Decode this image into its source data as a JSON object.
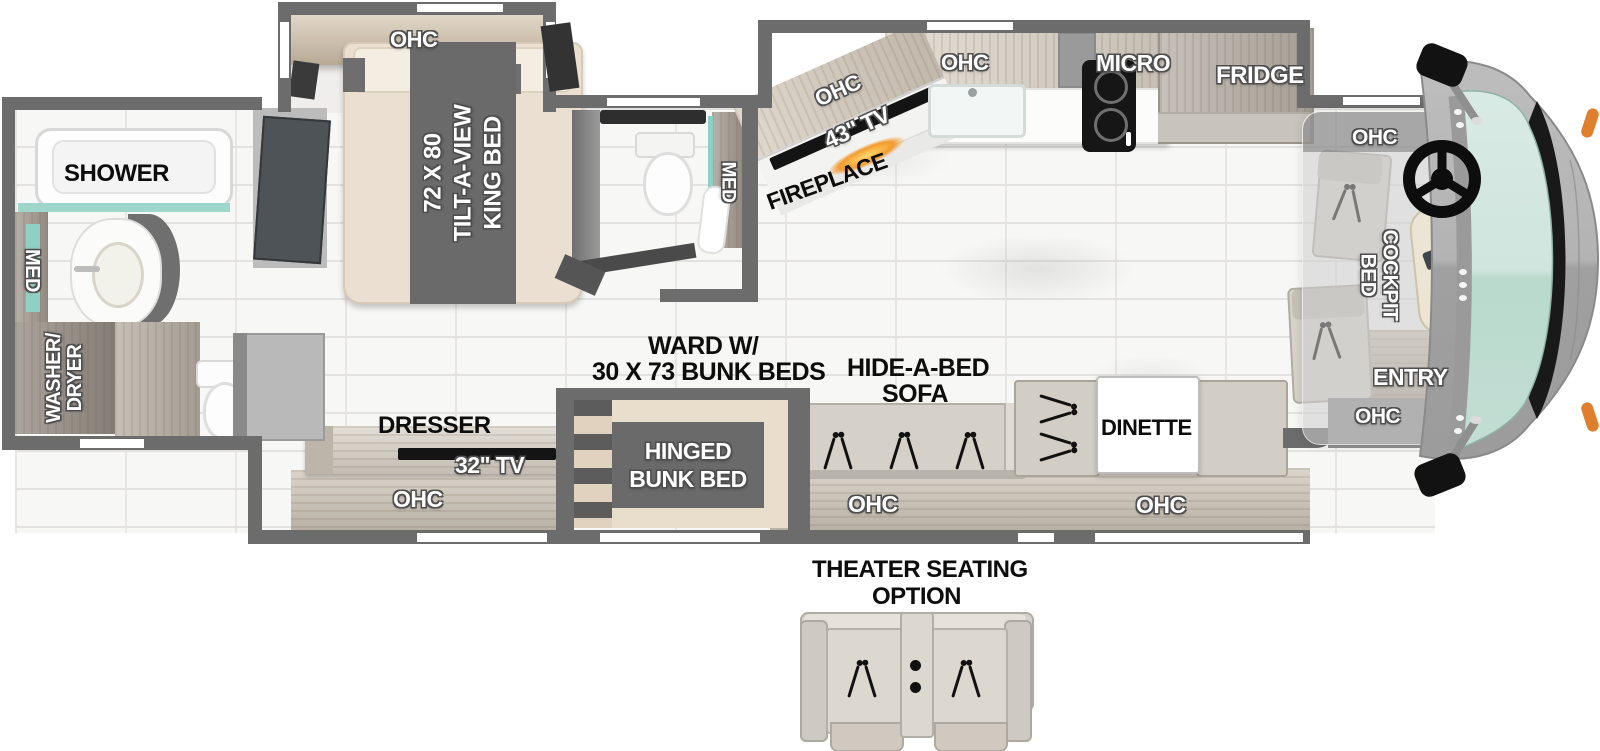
{
  "title": "Class A motorhome floor plan - bunk model",
  "colors": {
    "wall_gray": "#6c6c6c",
    "slide_gray": "#8f8f8f",
    "wood_light": "#cdc4b7",
    "wood_dark": "#a39a90",
    "mattress_tan": "#eadfd0",
    "runner_gray": "#6a6a6a",
    "glass_teal": "#c7e2da",
    "trim_black": "#191919",
    "flame_orange": "#f29b2e",
    "marker_orange": "#df7f2e",
    "label_white": "#ffffff",
    "label_black": "#0d0d0d"
  },
  "floorplan": {
    "rear_bath": {
      "shower": "SHOWER",
      "med": "MED",
      "washer": [
        "WASHER/",
        "DRYER"
      ]
    },
    "bedroom": {
      "ohc": "OHC",
      "bed": [
        "72 X 80",
        "TILT-A-VIEW",
        "KING BED"
      ]
    },
    "mid_bath": {
      "med": "MED"
    },
    "kitchen": {
      "ohc_angled": "OHC",
      "tv43": "43\" TV",
      "fireplace": "FIREPLACE",
      "ohc_sink": "OHC",
      "micro": "MICRO",
      "fridge": "FRIDGE"
    },
    "cockpit": {
      "ohc_top": "OHC",
      "bed": [
        "COCKPIT",
        "BED"
      ],
      "entry": "ENTRY",
      "ohc_entry": "OHC"
    },
    "living": {
      "ward": [
        "WARD W/",
        "30 X 73 BUNK BEDS"
      ],
      "sofa": [
        "HIDE-A-BED",
        "SOFA"
      ],
      "sofa_ohc": "OHC",
      "dinette": "DINETTE",
      "dinette_ohc": "OHC"
    },
    "bunk_room": {
      "dresser": "DRESSER",
      "tv32": "32\" TV",
      "ohc": "OHC",
      "bunk": [
        "HINGED",
        "BUNK BED"
      ]
    },
    "theater": {
      "title": [
        "THEATER SEATING",
        "OPTION"
      ]
    }
  }
}
